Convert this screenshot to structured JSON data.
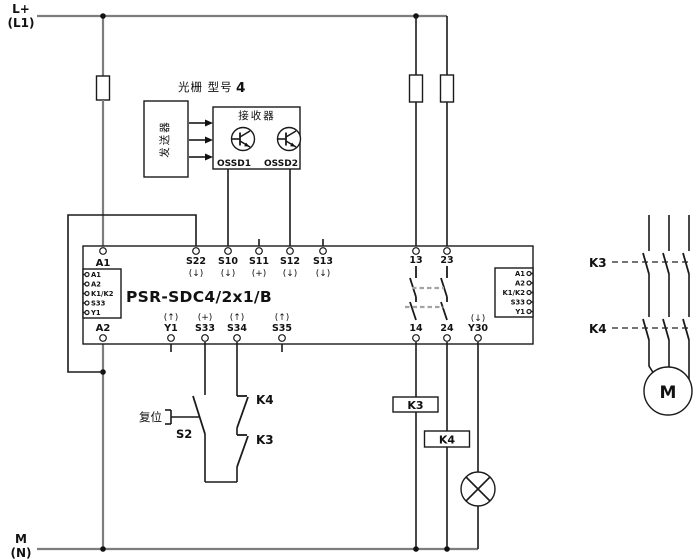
{
  "power": {
    "l_plus": "L+",
    "l1": "(L1)",
    "m": "M",
    "n": "(N)"
  },
  "light_curtain": {
    "title": "光栅 型号",
    "type_number": "4",
    "transmitter_label": "发送器",
    "receiver_label": "接收器",
    "ossd1_label": "OSSD1",
    "ossd2_label": "OSSD2"
  },
  "safety_relay": {
    "model": "PSR-SDC4/2x1/B",
    "terminals": {
      "a1": "A1",
      "a2": "A2",
      "s22": "S22",
      "s22_dir": "(↓)",
      "s10": "S10",
      "s10_dir": "(↓)",
      "s11": "S11",
      "s11_dir": "(+)",
      "s12": "S12",
      "s12_dir": "(↓)",
      "s13": "S13",
      "s13_dir": "(↓)",
      "y1": "Y1",
      "y1_dir": "(↑)",
      "s33": "S33",
      "s33_dir": "(+)",
      "s34": "S34",
      "s34_dir": "(↑)",
      "s35": "S35",
      "s35_dir": "(↑)",
      "y30": "Y30",
      "y30_dir": "(↓)",
      "no1_top": "13",
      "no1_bottom": "14",
      "no2_top": "23",
      "no2_bottom": "24"
    },
    "left_connector": [
      "A1",
      "A2",
      "K1/K2",
      "S33",
      "Y1"
    ],
    "right_connector": [
      "A1",
      "A2",
      "K1/K2",
      "S33",
      "Y1"
    ]
  },
  "reset_circuit": {
    "reset_label": "复位",
    "button_label": "S2",
    "feedback_top": "K4",
    "feedback_bottom": "K3"
  },
  "output_circuit": {
    "coil1": "K3",
    "coil2": "K4"
  },
  "motor_circuit": {
    "contactor1": "K3",
    "contactor2": "K4",
    "motor_label": "M"
  },
  "colors": {
    "background": "#ffffff",
    "wire": "#1a1a1a",
    "power_rail": "#7d7d7d",
    "mechanical_link_dash": "#a3a3a3"
  }
}
